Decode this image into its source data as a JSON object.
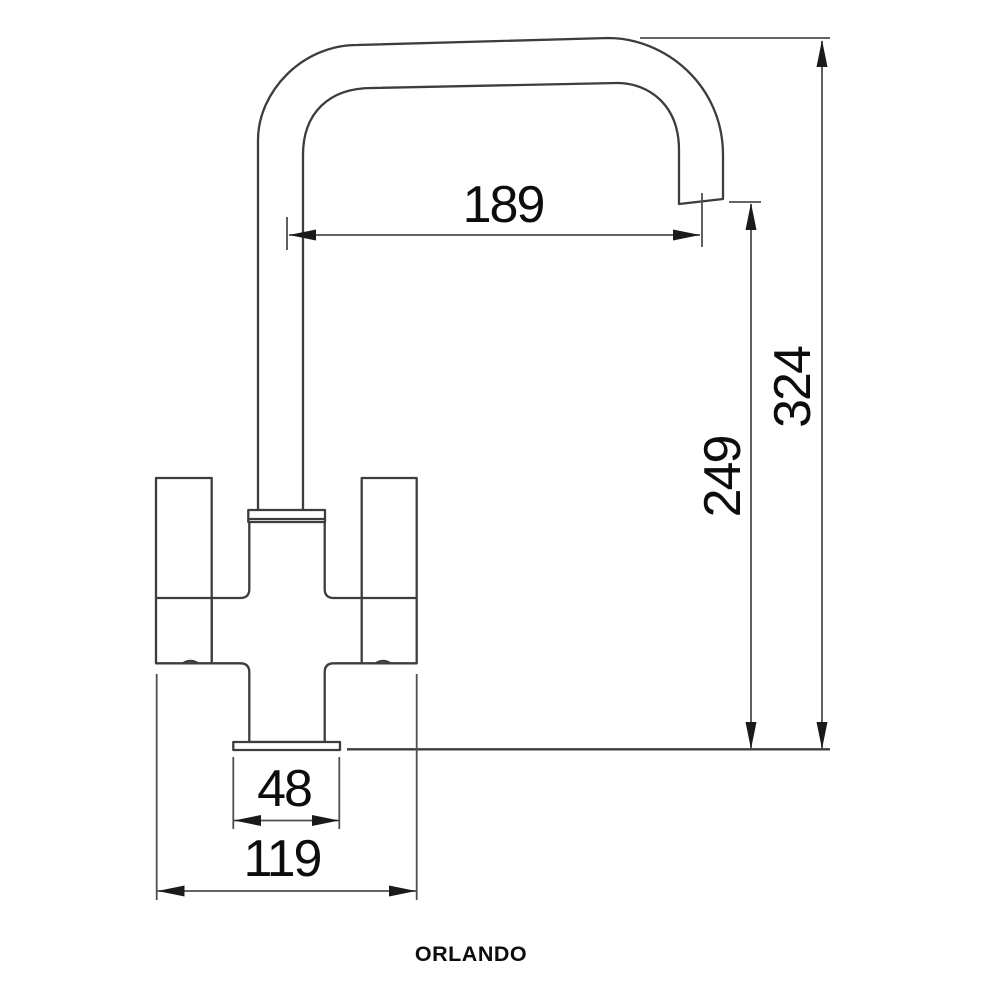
{
  "product": {
    "name": "ORLANDO"
  },
  "dimensions": {
    "spout_reach": "189",
    "overall_height": "324",
    "spout_outlet_height": "249",
    "base_width": "48",
    "body_width": "119"
  },
  "colors": {
    "background": "#ffffff",
    "drawing_outline": "#3d3d3d",
    "dimension_line": "#4f4f4f",
    "text": "#0d0d0d"
  }
}
